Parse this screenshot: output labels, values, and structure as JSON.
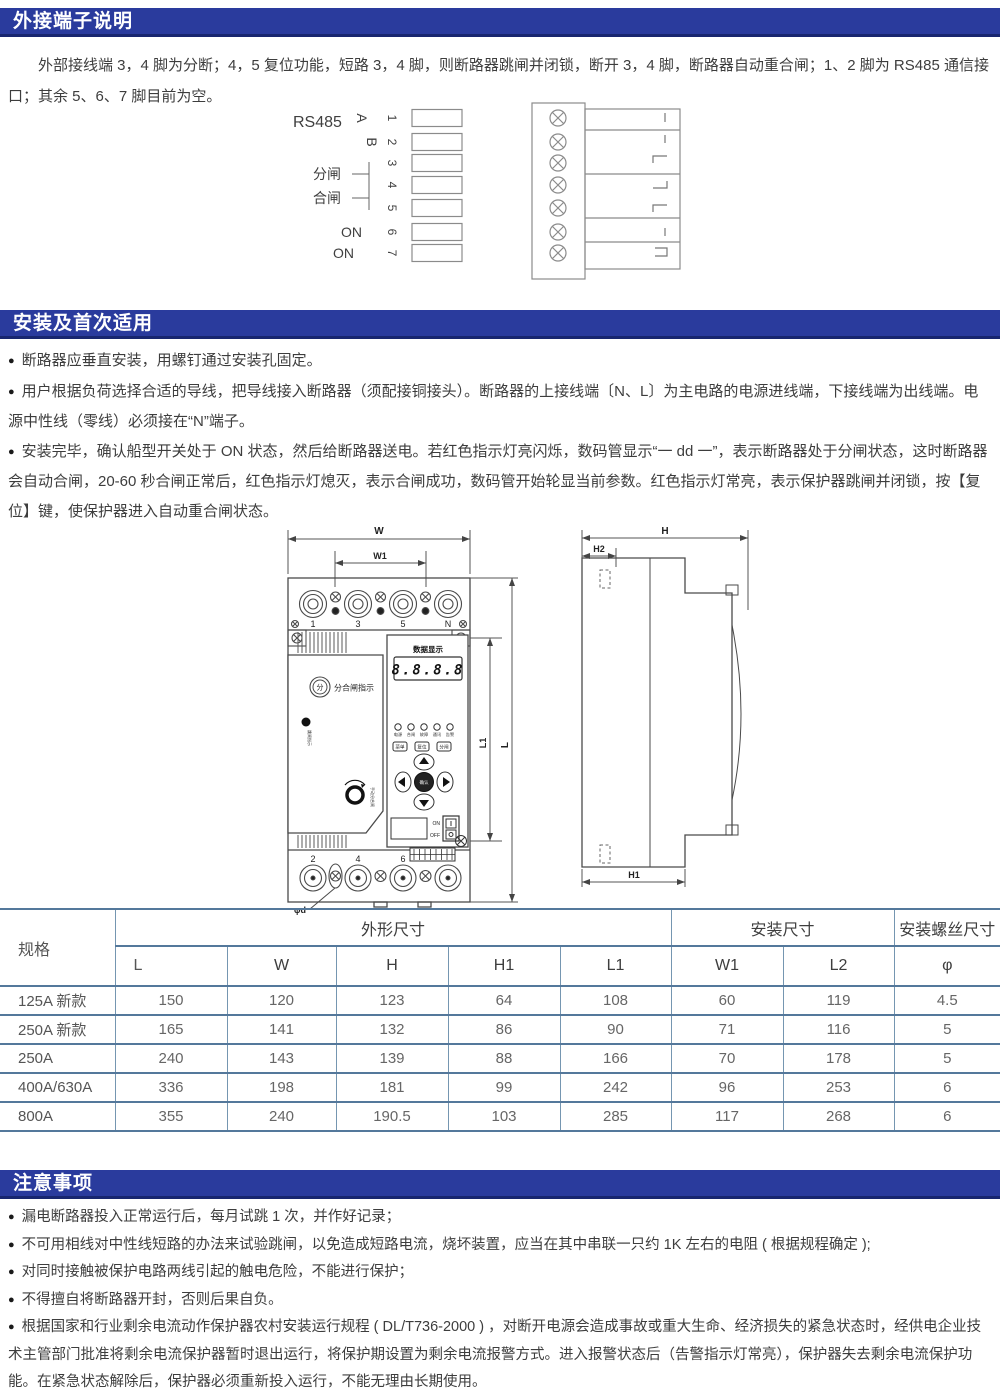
{
  "glyphs": {
    "bullet": "●"
  },
  "colors": {
    "accent": "#2a3b9d",
    "table_border": "#54789b",
    "text": "#3d3d3d"
  },
  "sec1": {
    "title": "外接端子说明",
    "paragraph": "外部接线端 3，4 脚为分断；4，5 复位功能，短路 3，4 脚，则断路器跳闸并闭锁，断开 3，4 脚，断路器自动重合闸；1、2 脚为 RS485 通信接口；其余 5、6、7 脚目前为空。",
    "diagram": {
      "rs485": "RS485",
      "a": "A",
      "b": "B",
      "p1": "1",
      "p2": "2",
      "p3": "3",
      "p4": "4",
      "p5": "5",
      "p6": "6",
      "p7": "7",
      "fen": "分闸",
      "he": "合闸",
      "on6": "ON",
      "on7": "ON"
    }
  },
  "sec2": {
    "title": "安装及首次适用",
    "b1": "断路器应垂直安装，用螺钉通过安装孔固定。",
    "b2": "用户根据负荷选择合适的导线，把导线接入断路器（须配接铜接头）。断路器的上接线端〔N、L〕为主电路的电源进线端，下接线端为出线端。电源中性线（零线）必须接在“N”端子。",
    "b3": "安装完毕，确认船型开关处于 ON 状态，然后给断路器送电。若红色指示灯亮闪烁，数码管显示“一 dd 一”，表示断路器处于分闸状态，这时断路器会自动合闸，20-60 秒合闸正常后，红色指示灯熄灭，表示合闸成功，数码管开始轮显当前参数。红色指示灯常亮，表示保护器跳闸并闭锁，按【复位】键，使保护器进入自动重合闸状态。"
  },
  "drawing": {
    "front": {
      "dim_w": "W",
      "dim_w1": "W1",
      "dim_l1": "L1",
      "dim_l": "L",
      "phi": "φd",
      "t_top": [
        "1",
        "3",
        "5",
        "N"
      ],
      "t_bot": [
        "2",
        "4",
        "6"
      ],
      "display_title": "数据显示",
      "display_value": "8.8.8.8",
      "fen": "分",
      "fen_label": "分合闸指示",
      "trip_note": "跳闸指示",
      "knob_note": "手动分合闸",
      "leds": [
        "电源",
        "合闸",
        "故障",
        "通讯",
        "告警"
      ],
      "btns": [
        "菜单",
        "复位",
        "分闸"
      ],
      "ok": "确认",
      "on": "ON",
      "off": "OFF"
    },
    "side": {
      "dim_h": "H",
      "dim_h2": "H2",
      "dim_h1": "H1"
    }
  },
  "table": {
    "h_spec": "规格",
    "h_dims": "外形尺寸",
    "h_mount": "安装尺寸",
    "h_screw": "安装螺丝尺寸",
    "cols": [
      "L",
      "W",
      "H",
      "H1",
      "L1",
      "W1",
      "L2",
      "φ"
    ],
    "rows": [
      {
        "spec": "125A 新款",
        "v": [
          "150",
          "120",
          "123",
          "64",
          "108",
          "60",
          "119",
          "4.5"
        ]
      },
      {
        "spec": "250A 新款",
        "v": [
          "165",
          "141",
          "132",
          "86",
          "90",
          "71",
          "116",
          "5"
        ]
      },
      {
        "spec": "250A",
        "v": [
          "240",
          "143",
          "139",
          "88",
          "166",
          "70",
          "178",
          "5"
        ]
      },
      {
        "spec": "400A/630A",
        "v": [
          "336",
          "198",
          "181",
          "99",
          "242",
          "96",
          "253",
          "6"
        ]
      },
      {
        "spec": "800A",
        "v": [
          "355",
          "240",
          "190.5",
          "103",
          "285",
          "117",
          "268",
          "6"
        ]
      }
    ]
  },
  "sec3": {
    "title": "注意事项",
    "b1": "漏电断路器投入正常运行后，每月试跳 1 次，并作好记录；",
    "b2": "不可用相线对中性线短路的办法来试验跳闸，以免造成短路电流，烧坏装置，应当在其中串联一只约 1K 左右的电阻 ( 根据规程确定 );",
    "b3": "对同时接触被保护电路两线引起的触电危险，不能进行保护；",
    "b4": "不得擅自将断路器开封，否则后果自负。",
    "b5": "根据国家和行业剩余电流动作保护器农村安装运行规程 ( DL/T736-2000 ) ，对断开电源会造成事故或重大生命、经济损失的紧急状态时，经供电企业技术主管部门批准将剩余电流保护器暂时退出运行，将保护期设置为剩余电流报警方式。进入报警状态后（告警指示灯常亮），保护器失去剩余电流保护功能。在紧急状态解除后，保护器必须重新投入运行，不能无理由长期使用。"
  }
}
